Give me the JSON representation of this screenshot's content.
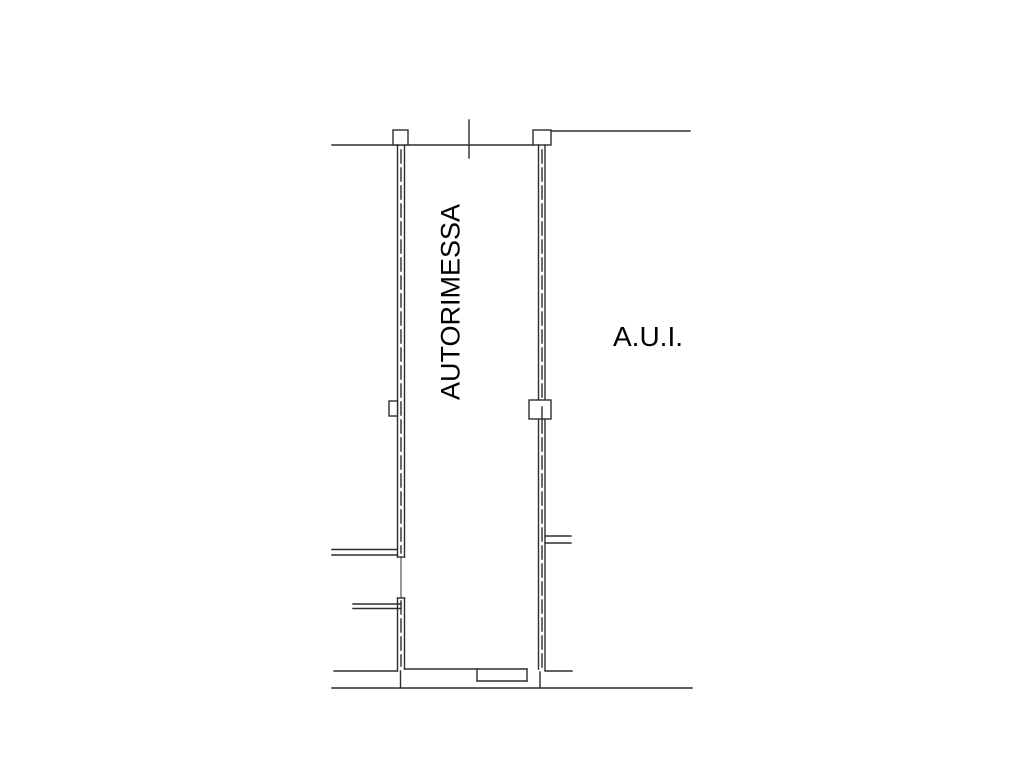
{
  "page": {
    "background_color": "#ffffff"
  },
  "plan": {
    "room_label": "AUTORIMESSA",
    "area_label": "A.U.I.",
    "line_color": "#2e2e2e",
    "text_color": "#000000"
  }
}
